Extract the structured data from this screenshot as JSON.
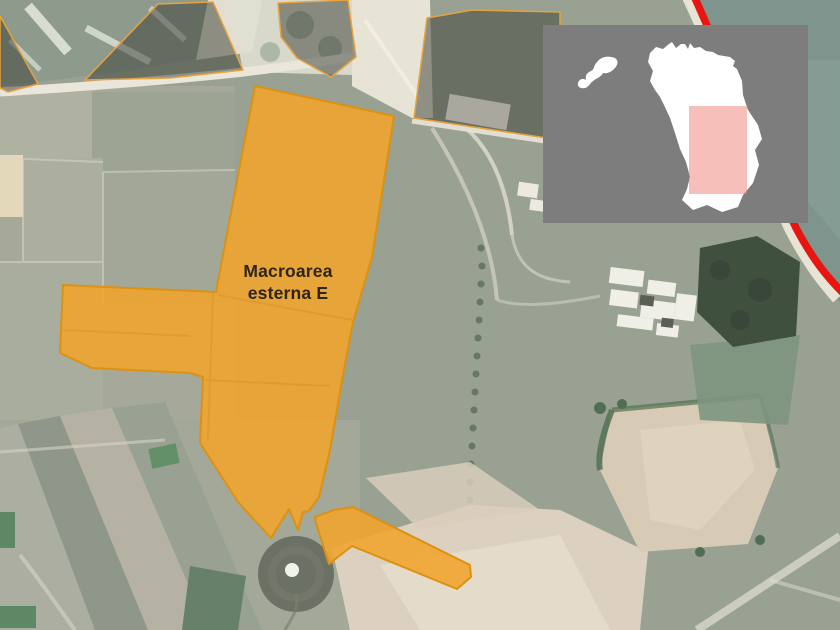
{
  "figure": {
    "zone_label": {
      "line1": "Macroarea",
      "line2": "esterna E",
      "full_text": "Macroarea esterna E"
    },
    "colors": {
      "zone_fill": "#F0A42C",
      "zone_stroke": "#DD9110",
      "dark_zone_fill": "#3F423A",
      "coastline_red": "#E81511",
      "label_text": "#2E2418",
      "inset_background": "#7D7D7D",
      "inset_territory": "#FFFFFF",
      "inset_highlight": "#ED8074"
    }
  }
}
